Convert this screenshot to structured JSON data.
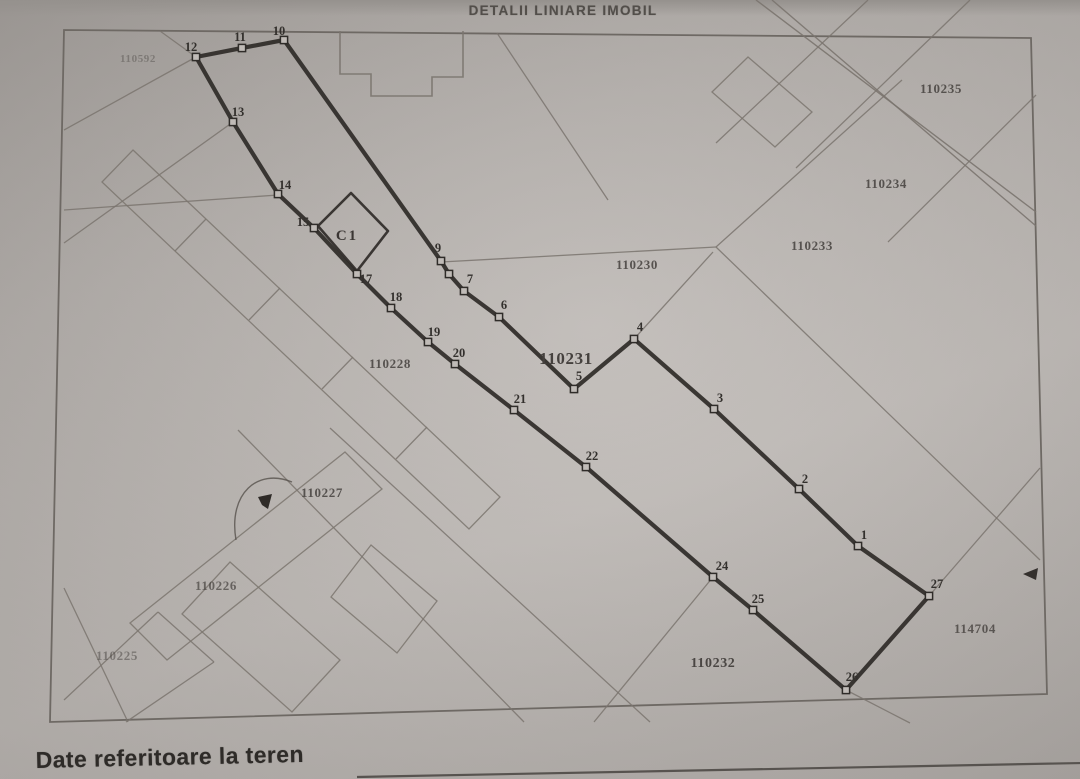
{
  "document": {
    "title": "DETALII LINIARE IMOBIL",
    "section_heading": "Date referitoare la teren"
  },
  "colors": {
    "paper": "#b5b0ac",
    "ink_thick_boundary": "#2f2c29",
    "ink_thin_line": "#7b756f",
    "ink_frame": "#6e6964",
    "ink_text": "#45413e",
    "marker_fill": "#c0bbb7"
  },
  "map": {
    "frame": "64,30 1031,38 1047,694 50,722",
    "boundary_polygon": "858,546 799,489 714,409 634,339 574,389 499,317 464,291 449,274 441,261 284,40 242,48 196,57 233,122 278,194 314,228 357,274 391,308 428,342 455,364 514,410 586,467 713,577 753,610 846,690 929,596",
    "vertex_markers": [
      {
        "label": "1",
        "x": 858,
        "y": 546,
        "lx": 864,
        "ly": 539
      },
      {
        "label": "2",
        "x": 799,
        "y": 489,
        "lx": 805,
        "ly": 483
      },
      {
        "label": "3",
        "x": 714,
        "y": 409,
        "lx": 720,
        "ly": 402
      },
      {
        "label": "4",
        "x": 634,
        "y": 339,
        "lx": 640,
        "ly": 331
      },
      {
        "label": "5",
        "x": 574,
        "y": 389,
        "lx": 579,
        "ly": 380
      },
      {
        "label": "6",
        "x": 499,
        "y": 317,
        "lx": 504,
        "ly": 309
      },
      {
        "label": "7",
        "x": 464,
        "y": 291,
        "lx": 470,
        "ly": 283
      },
      {
        "label": "",
        "x": 449,
        "y": 274,
        "lx": 0,
        "ly": 0
      },
      {
        "label": "9",
        "x": 441,
        "y": 261,
        "lx": 438,
        "ly": 252
      },
      {
        "label": "10",
        "x": 284,
        "y": 40,
        "lx": 279,
        "ly": 35
      },
      {
        "label": "11",
        "x": 242,
        "y": 48,
        "lx": 240,
        "ly": 41
      },
      {
        "label": "12",
        "x": 196,
        "y": 57,
        "lx": 191,
        "ly": 51
      },
      {
        "label": "13",
        "x": 233,
        "y": 122,
        "lx": 238,
        "ly": 116
      },
      {
        "label": "14",
        "x": 278,
        "y": 194,
        "lx": 285,
        "ly": 189
      },
      {
        "label": "15",
        "x": 314,
        "y": 228,
        "lx": 303,
        "ly": 226
      },
      {
        "label": "17",
        "x": 357,
        "y": 274,
        "lx": 366,
        "ly": 283
      },
      {
        "label": "18",
        "x": 391,
        "y": 308,
        "lx": 396,
        "ly": 301
      },
      {
        "label": "19",
        "x": 428,
        "y": 342,
        "lx": 434,
        "ly": 336
      },
      {
        "label": "20",
        "x": 455,
        "y": 364,
        "lx": 459,
        "ly": 357
      },
      {
        "label": "21",
        "x": 514,
        "y": 410,
        "lx": 520,
        "ly": 403
      },
      {
        "label": "22",
        "x": 586,
        "y": 467,
        "lx": 592,
        "ly": 460
      },
      {
        "label": "24",
        "x": 713,
        "y": 577,
        "lx": 722,
        "ly": 570
      },
      {
        "label": "25",
        "x": 753,
        "y": 610,
        "lx": 758,
        "ly": 603
      },
      {
        "label": "26",
        "x": 846,
        "y": 690,
        "lx": 852,
        "ly": 681
      },
      {
        "label": "27",
        "x": 929,
        "y": 596,
        "lx": 937,
        "ly": 588
      }
    ],
    "building_c1": {
      "label": "C1",
      "outline": "351,193 388,231 357,271 318,226",
      "label_x": 347,
      "label_y": 240
    },
    "top_building_outline": "340,31 340,74 371,74 371,96 432,96 432,77 463,77 463,31",
    "parcel_labels": [
      {
        "text": "110592",
        "x": 138,
        "y": 62,
        "size": 11,
        "opacity": 0.4,
        "bold": false
      },
      {
        "text": "110235",
        "x": 941,
        "y": 93,
        "size": 13,
        "opacity": 0.85,
        "bold": false
      },
      {
        "text": "110234",
        "x": 886,
        "y": 188,
        "size": 13,
        "opacity": 0.85,
        "bold": false
      },
      {
        "text": "110233",
        "x": 812,
        "y": 250,
        "size": 13,
        "opacity": 0.85,
        "bold": false
      },
      {
        "text": "110230",
        "x": 637,
        "y": 269,
        "size": 13,
        "opacity": 0.85,
        "bold": false
      },
      {
        "text": "110231",
        "x": 566,
        "y": 364,
        "size": 17,
        "opacity": 1,
        "bold": true
      },
      {
        "text": "110228",
        "x": 390,
        "y": 368,
        "size": 13,
        "opacity": 0.85,
        "bold": false
      },
      {
        "text": "110227",
        "x": 322,
        "y": 497,
        "size": 13,
        "opacity": 0.85,
        "bold": false
      },
      {
        "text": "110226",
        "x": 216,
        "y": 590,
        "size": 13,
        "opacity": 0.7,
        "bold": false
      },
      {
        "text": "110225",
        "x": 117,
        "y": 660,
        "size": 13,
        "opacity": 0.5,
        "bold": false
      },
      {
        "text": "110232",
        "x": 713,
        "y": 667,
        "size": 14,
        "opacity": 0.95,
        "bold": false
      },
      {
        "text": "114704",
        "x": 975,
        "y": 633,
        "size": 13,
        "opacity": 0.8,
        "bold": false
      }
    ],
    "thin_segments": [
      [
        441,
        262,
        716,
        247
      ],
      [
        716,
        247,
        902,
        80
      ],
      [
        716,
        247,
        1040,
        560
      ],
      [
        634,
        339,
        713,
        252
      ],
      [
        929,
        596,
        1040,
        468
      ],
      [
        846,
        690,
        910,
        723
      ],
      [
        713,
        577,
        594,
        722
      ],
      [
        196,
        57,
        64,
        130
      ],
      [
        196,
        57,
        160,
        31
      ],
      [
        233,
        122,
        64,
        243
      ],
      [
        278,
        195,
        64,
        210
      ],
      [
        497,
        33,
        608,
        200
      ],
      [
        868,
        0,
        716,
        143
      ],
      [
        970,
        0,
        796,
        168
      ],
      [
        1036,
        95,
        888,
        242
      ],
      [
        64,
        588,
        128,
        722
      ],
      [
        64,
        700,
        158,
        612
      ],
      [
        158,
        612,
        214,
        662
      ],
      [
        214,
        662,
        126,
        722
      ],
      [
        238,
        430,
        524,
        722
      ],
      [
        330,
        428,
        650,
        722
      ],
      [
        206,
        219,
        175,
        251
      ],
      [
        280,
        288,
        249,
        320
      ],
      [
        353,
        357,
        322,
        389
      ],
      [
        427,
        427,
        396,
        459
      ]
    ],
    "roads": [
      [
        756,
        0,
        1036,
        212
      ],
      [
        772,
        0,
        1036,
        226
      ]
    ],
    "thin_polygons": [
      "712,92 748,57 812,112 775,147",
      "230,562 340,660 292,712 182,614",
      "371,545 437,601 397,653 331,597",
      "130,623 345,452 382,489 167,660",
      "133,150 500,497 469,529 102,182"
    ],
    "annotations": {
      "arrow_right": "1023,574 1038,568 1036,580",
      "ink_blob": "258,497 272,494 268,509 262,505",
      "hand_arc": "M 236,540 C 228,493 258,468 292,482"
    },
    "footer_rule": [
      357,
      777,
      1082,
      763
    ]
  }
}
